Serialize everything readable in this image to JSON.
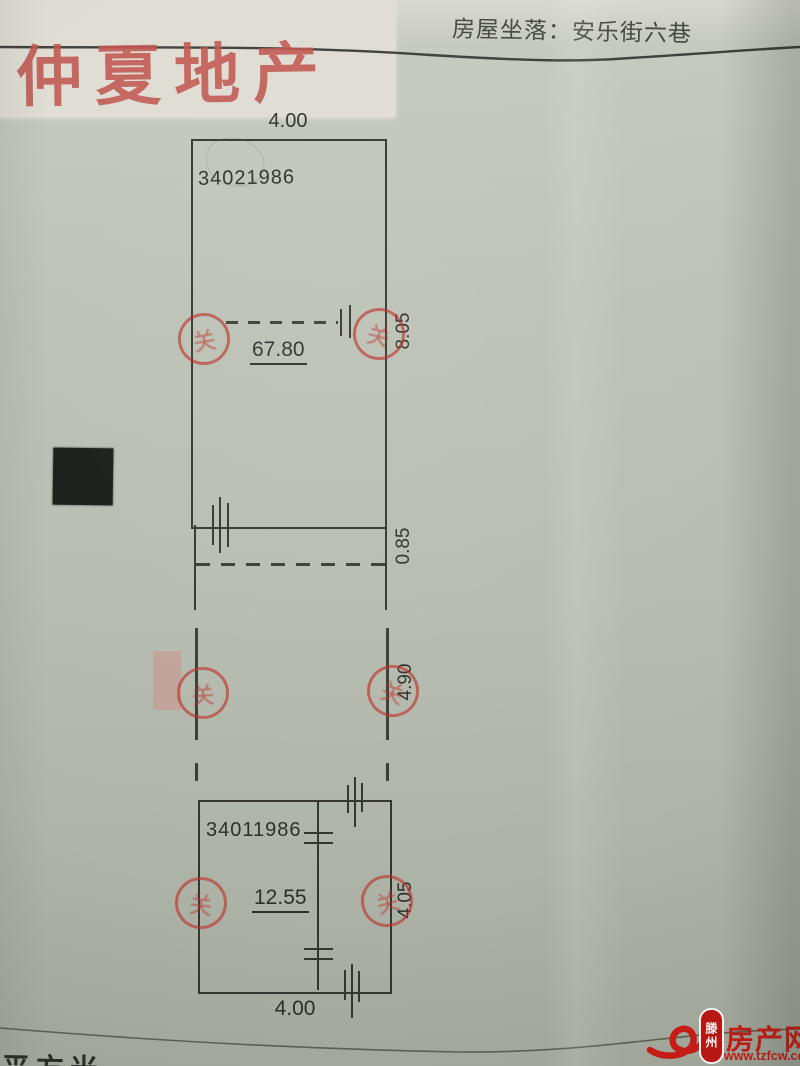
{
  "page": {
    "paper_color": "#b9beb2",
    "accent_red": "#c0544d"
  },
  "watermark": {
    "text": "仲夏地产",
    "color": "#c0544d"
  },
  "header": {
    "location_label": "房屋坐落：安乐街六巷"
  },
  "plan": {
    "upper": {
      "serial": "34021986",
      "width_top": "4.00",
      "area": "67.80",
      "side_dim": "8.05",
      "strip_dim": "0.85"
    },
    "middle": {
      "side_dim": "4.90"
    },
    "lower": {
      "serial": "34011986",
      "area": "12.55",
      "side_dim": "4.05",
      "width_bottom": "4.00"
    }
  },
  "stamp": {
    "glyph": "关"
  },
  "footer": {
    "partial_text": "平方米",
    "logo": {
      "seal_text": "滕州",
      "site_name": "房产网",
      "site_url": "www.tzfcw.com.cn",
      "color": "#ce1c16"
    }
  }
}
